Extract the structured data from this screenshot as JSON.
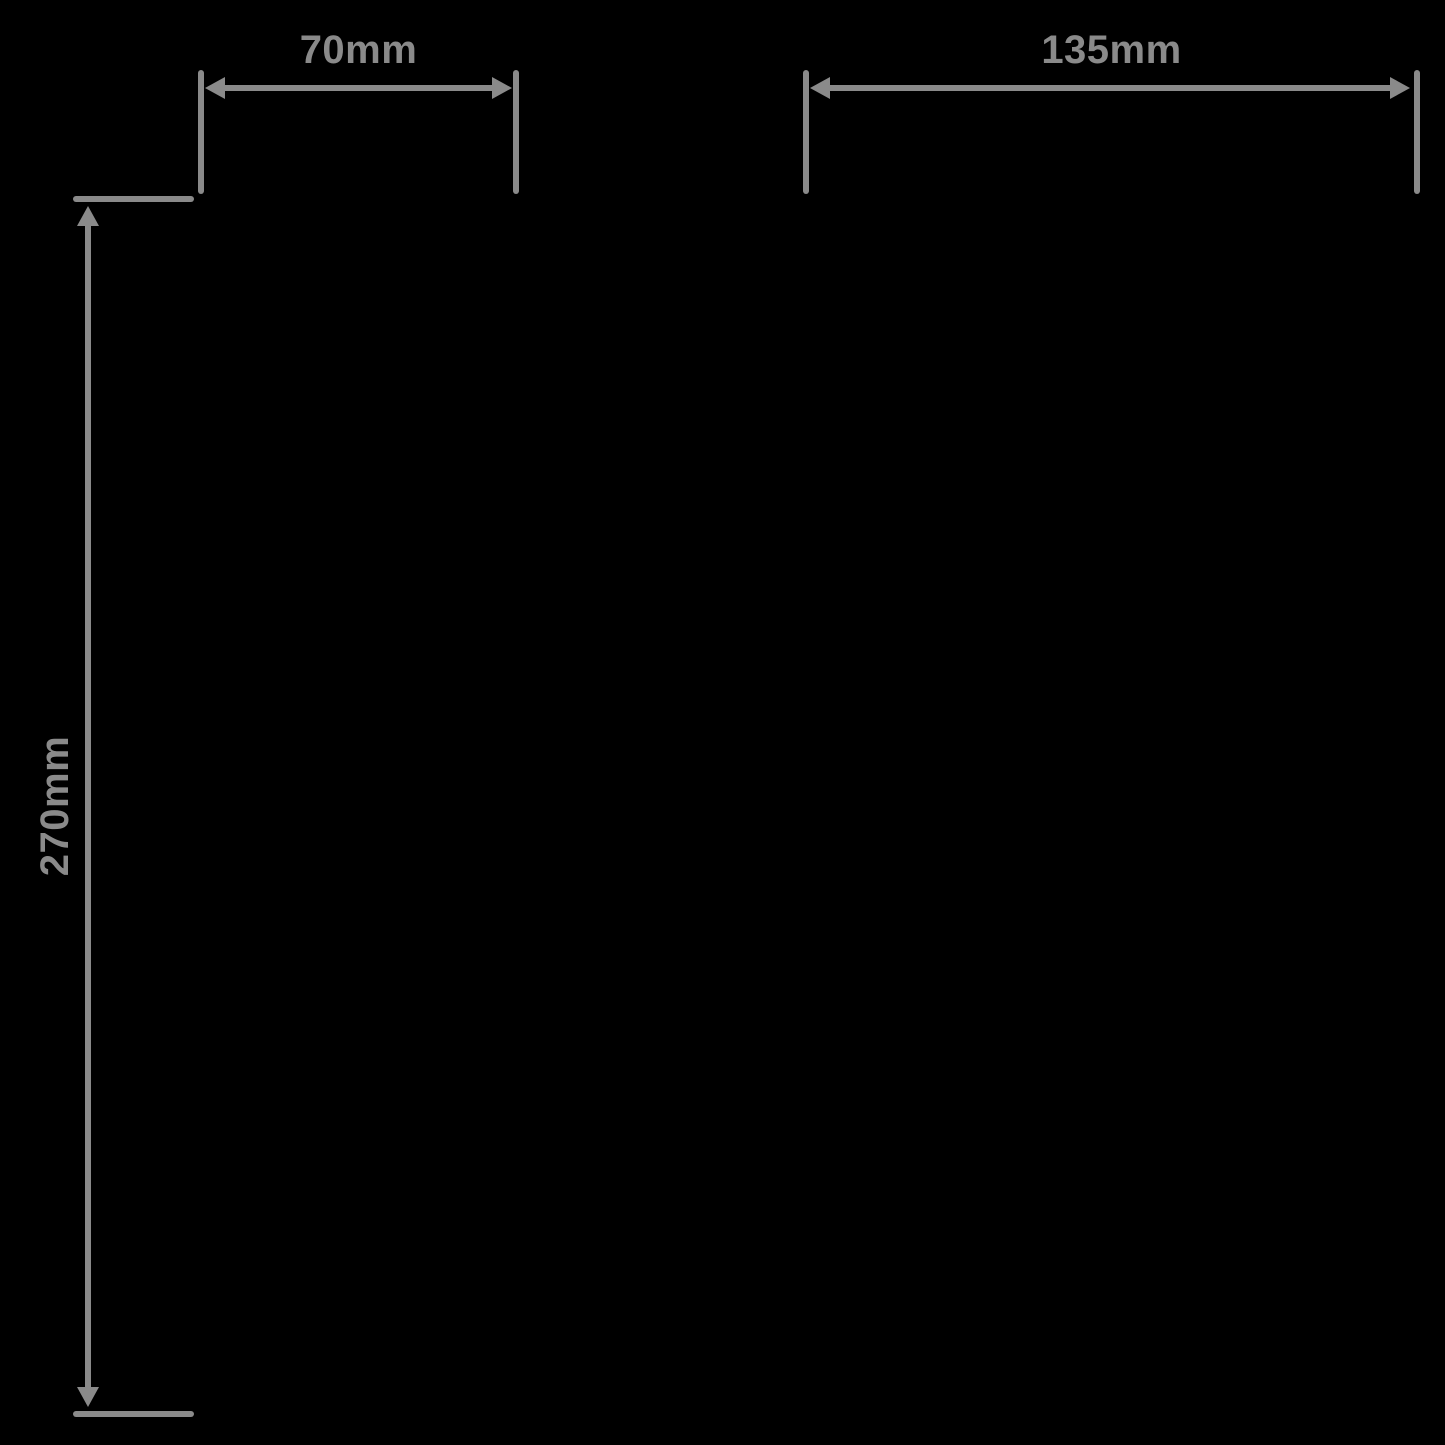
{
  "page": {
    "background_color": "#000000"
  },
  "diagram": {
    "line_color": "#8a8a8a",
    "dimensions": [
      {
        "label": "70mm",
        "orientation": "horizontal",
        "position": "top-left"
      },
      {
        "label": "135mm",
        "orientation": "horizontal",
        "position": "top-right"
      },
      {
        "label": "270mm",
        "orientation": "vertical",
        "position": "left"
      }
    ]
  }
}
